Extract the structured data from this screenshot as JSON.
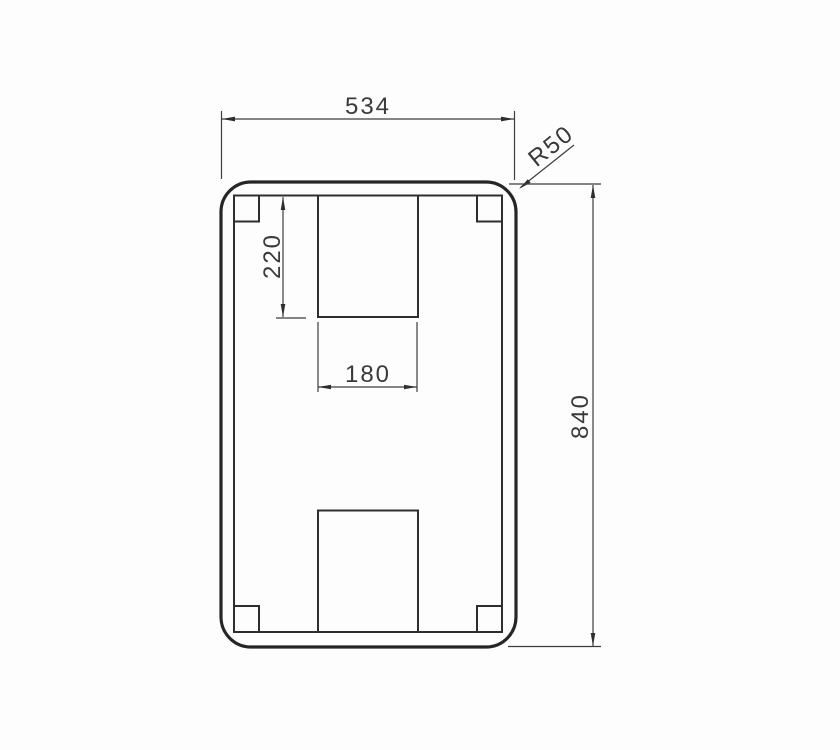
{
  "drawing": {
    "type": "technical-drawing",
    "view": "plate-with-notches-front-view",
    "labels": {
      "outer_width": "534",
      "outer_height": "840",
      "corner_radius": "R50",
      "notch_depth": "220",
      "notch_width": "180"
    },
    "colors": {
      "line_thick": "#262626",
      "line_medium": "#2e2e2e",
      "line_thin": "#3d3d3d",
      "text": "#3a3a3a",
      "background": "#fdfdfd"
    }
  }
}
